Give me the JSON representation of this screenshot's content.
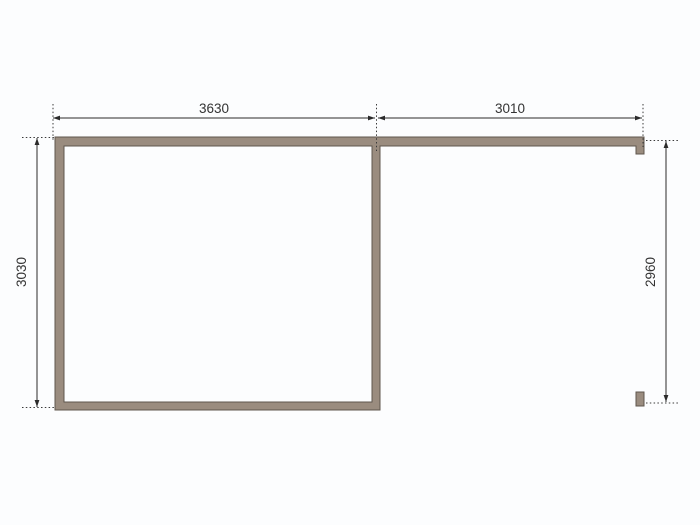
{
  "drawing": {
    "colors": {
      "background": "#fcfdfe",
      "wall_fill": "#9a8c7f",
      "wall_outline": "#5f564d",
      "dim_line": "#2b2b2b",
      "label_text": "#333333"
    },
    "dimensions": {
      "top_left": "3630",
      "top_right": "3010",
      "left": "3030",
      "right": "2960"
    }
  }
}
